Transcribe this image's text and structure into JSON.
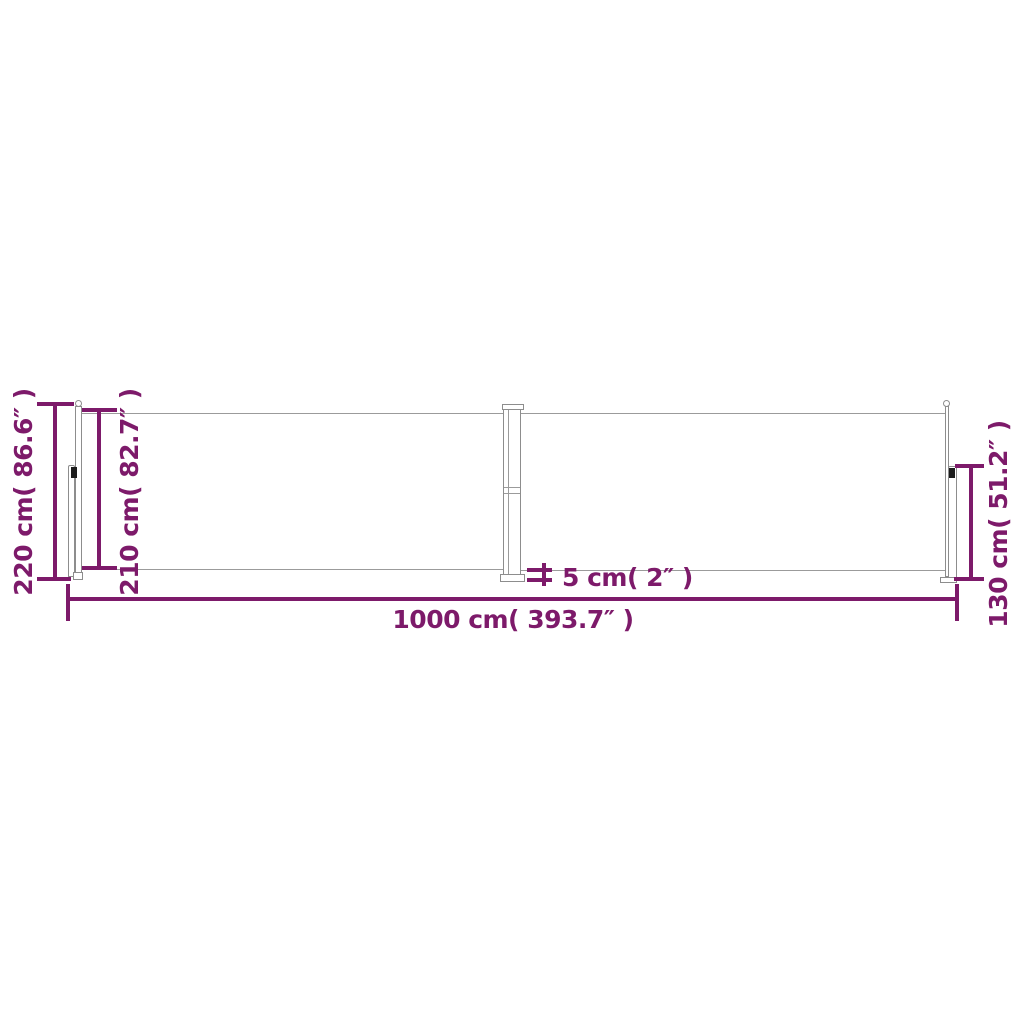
{
  "diagram": {
    "subject": "retractable-double-side-awning-dimension-diagram",
    "colors": {
      "dimension_accent": "#7d1a6a",
      "structure_gray": "#9b9b9b",
      "background": "#ffffff",
      "clip_dark": "#1c1c1c"
    },
    "labels": {
      "total_height": "220 cm( 86.6″ )",
      "fabric_height": "210 cm( 82.7″ )",
      "end_post_height": "130 cm( 51.2″ )",
      "total_length": "1000 cm( 393.7″ )",
      "pole_width": "5 cm( 2″ )"
    }
  }
}
